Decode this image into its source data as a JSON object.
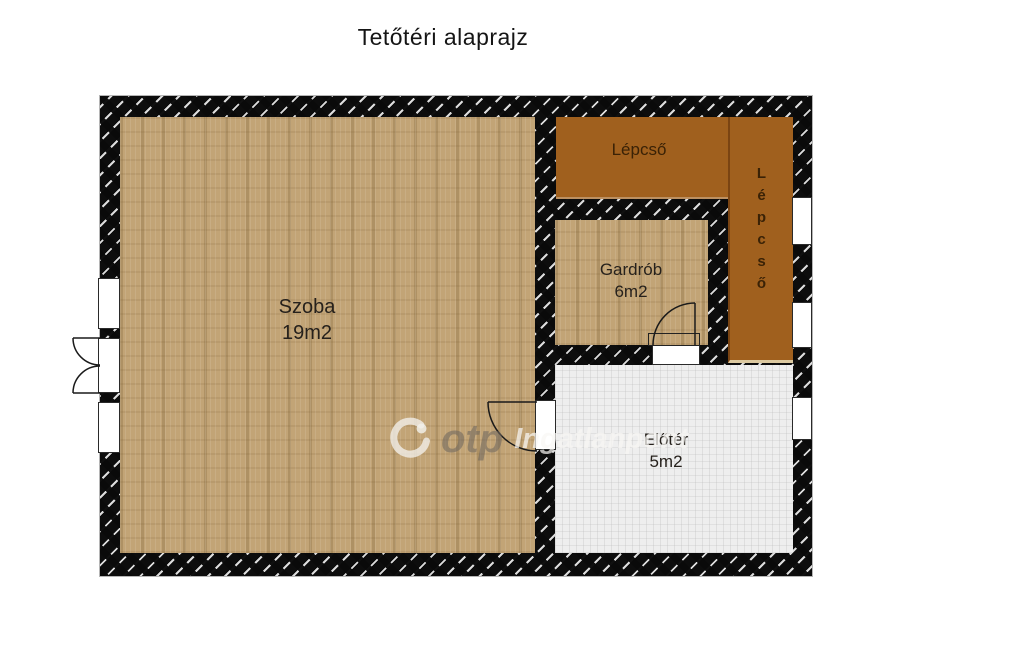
{
  "title": "Tetőtéri alaprajz",
  "rooms": {
    "szoba": {
      "name": "Szoba",
      "area": "19m2"
    },
    "lepcso_top": {
      "name": "Lépcső"
    },
    "lepcso_side": {
      "name": "Lépcső"
    },
    "gardrob": {
      "name": "Gardrób",
      "area": "6m2"
    },
    "eloter": {
      "name": "Előtér",
      "area": "5m2"
    }
  },
  "watermark": {
    "brand": "otp",
    "suffix": "Ingatlanpont"
  },
  "colors": {
    "floor_tan": "#c2a476",
    "stairs_brown": "#a0601e",
    "hall_gray": "#eeeeee",
    "wall": "#0d0d0d",
    "label_dark": "#26211c",
    "stairs_label": "#3a2206"
  }
}
